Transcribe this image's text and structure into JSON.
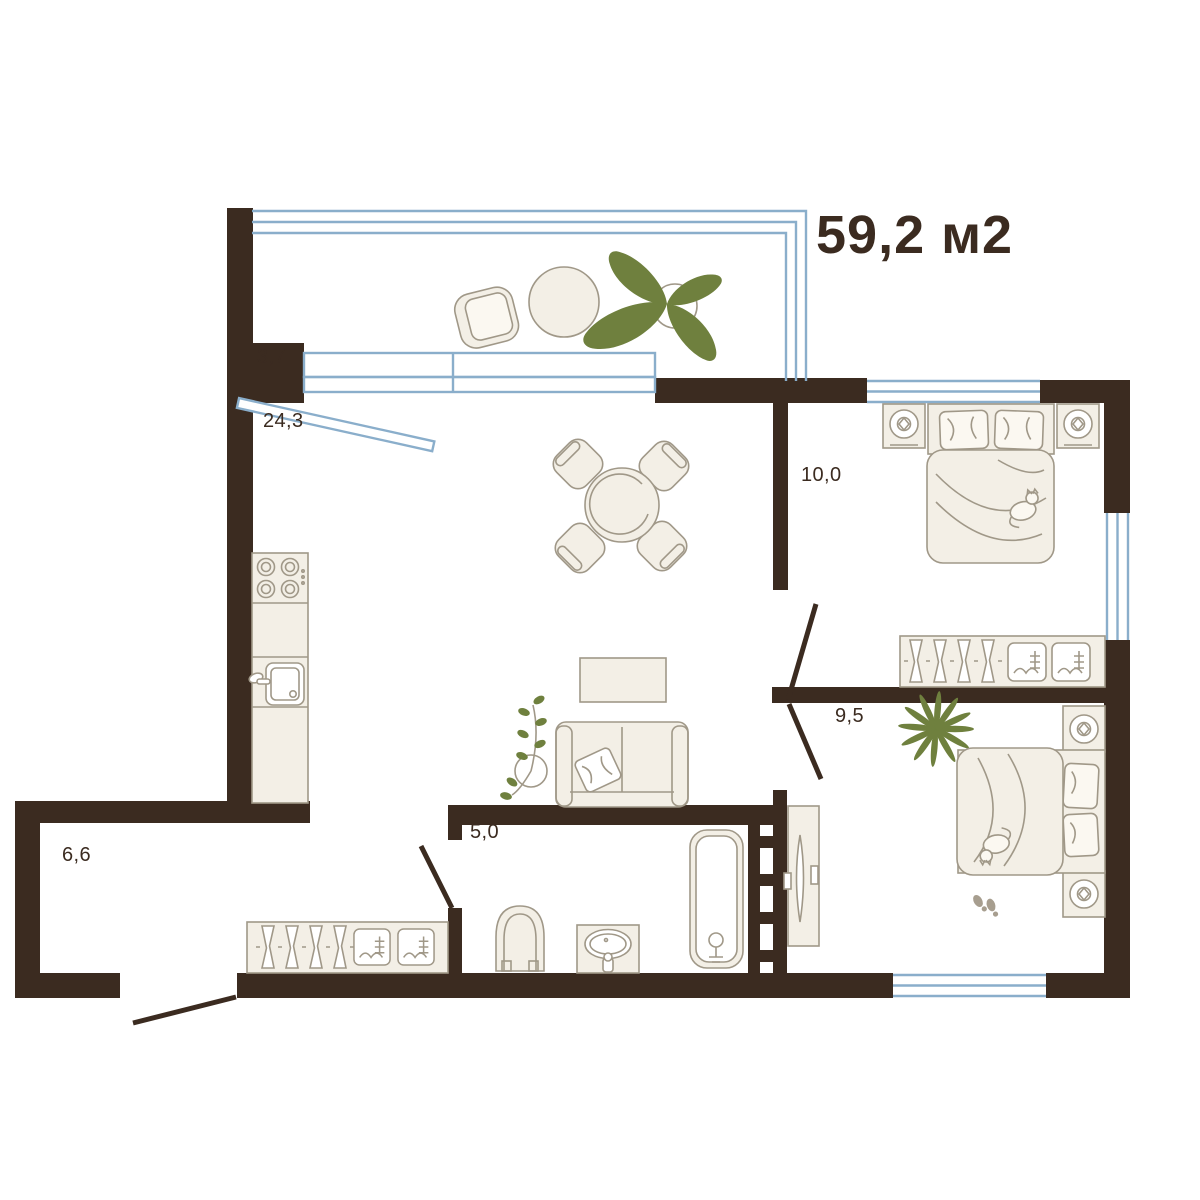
{
  "title": {
    "area_label": "59,2 м2"
  },
  "rooms": [
    {
      "id": "balcony",
      "area": "3,7"
    },
    {
      "id": "living-kitchen",
      "area": "24,3"
    },
    {
      "id": "bedroom-1",
      "area": "10,0"
    },
    {
      "id": "bedroom-2",
      "area": "9,5"
    },
    {
      "id": "bathroom",
      "area": "5,0"
    },
    {
      "id": "hallway",
      "area": "6,6"
    }
  ],
  "colors": {
    "wall": "#3B2B20",
    "window": "#8AAECB",
    "furniture_fill": "#F3EFE6",
    "furniture_stroke": "#A09888",
    "plant_green": "#6F803E",
    "label": "#3B2B20"
  }
}
